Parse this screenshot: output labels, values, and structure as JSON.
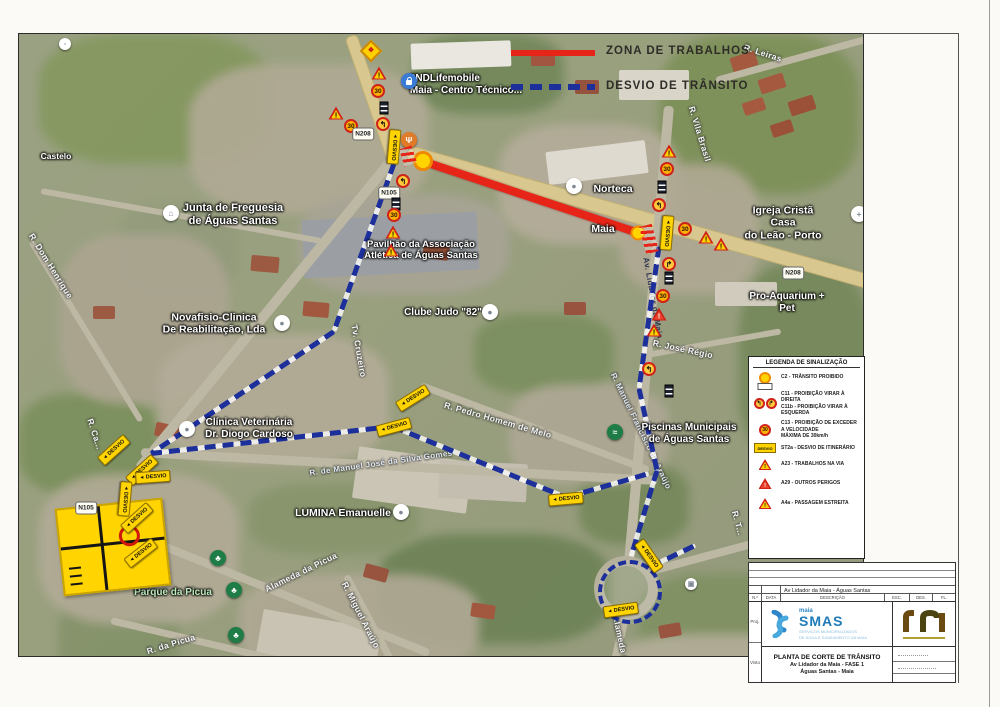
{
  "legend_top": {
    "work_zone": "ZONA DE TRABALHOS",
    "detour": "DESVIO DE TRÂNSITO"
  },
  "colors": {
    "work_zone": "#e62417",
    "detour": "#1d2f9b",
    "desvio_sign": "#ffd400",
    "smas_blue": "#1f7ab8"
  },
  "signs": {
    "speed": "30",
    "desvio": "DESVIO",
    "arrow_left": "◄",
    "n208": "N208",
    "n105": "N105"
  },
  "map": {
    "labels": {
      "castelo": "Castelo",
      "dom_henrique": "R. Dom Henrique",
      "junta": "Junta de Freguesia\nde Águas Santas",
      "novafisio": "Novafisio-Clinica\nDe Reabilitação, Lda",
      "clinica_vet": "Clínica Veterinária\nDr. Diogo Cardoso",
      "ndlife": "2NDLifemobile\nMaia - Centro Técnico...",
      "norteca": "Norteca",
      "maia": "Maia",
      "igreja": "Igreja Cristã Casa\ndo Leão - Porto",
      "pro_aquarium": "Pro-Aquarium + Pet",
      "clube_judo": "Clube Judo \"82\"",
      "pavilhao": "Pavilhão da Associação\nAtlética de Águas Santas",
      "piscinas": "Piscinas Municipais\nde Águas Santas",
      "lumina": "LUMINA Emanuelle",
      "parque": "Parque da Picua",
      "r_leiras": "R. Leiras",
      "r_vila_brasil": "R. Vila Brasil",
      "tv_cruzeiro": "Tv. Cruzeiro",
      "r_pedro": "R. Pedro Homem de Melo",
      "r_jose_regio": "R. José Régio",
      "r_manuel_jose": "R. de Manuel José da Silva Gomes",
      "r_manuel_fran": "R. Manuel Francisco de Araújo",
      "alameda": "Alameda da Picua",
      "r_miguel": "R. Miguel Araújo",
      "r_da_picua": "R. da Picua",
      "alameda2": "Alameda da...",
      "av_lidador": "Av. Lidador da Maia",
      "r_ca": "R. Ca...",
      "r_t": "R. T..."
    }
  },
  "sign_legend": {
    "title": "LEGENDA DE SINALIZAÇÃO",
    "items": [
      {
        "text": "C2 - TRÂNSITO PROIBIDO"
      },
      {
        "text": "C11 - PROIBIÇÃO VIRAR À DIREITA\nC11b - PROIBIÇÃO VIRAR À ESQUERDA"
      },
      {
        "text": "C13 - PROIBIÇÃO DE EXCEDER A VELOCIDADE\nMÁXIMA DE 30km/h"
      },
      {
        "text": "ST2a - DESVIO DE ITINERÁRIO"
      },
      {
        "text": "A23 - TRABALHOS NA VIA"
      },
      {
        "text": "A29 - OUTROS PERIGOS"
      },
      {
        "text": "A4a - PASSAGEM ESTREITA"
      }
    ]
  },
  "title_block": {
    "revision_text": "Av Lidador da Maia - Águas Santas",
    "cols": [
      "N.º",
      "DATA",
      "DESCRIÇÃO",
      "ESC.",
      "DES.",
      "FL."
    ],
    "side_labels": [
      "Proj.",
      "Visto"
    ],
    "brand_top": "maia",
    "brand": "SMAS",
    "brand_sub": "SERVIÇOS MUNICIPALIZADOS\nDE ÁGUA E SANEAMENTO DA MAIA",
    "title": "PLANTA DE CORTE DE TRÂNSITO",
    "subtitle1": "Av Lidador da Maia - FASE 1",
    "subtitle2": "Águas Santas - Maia"
  }
}
